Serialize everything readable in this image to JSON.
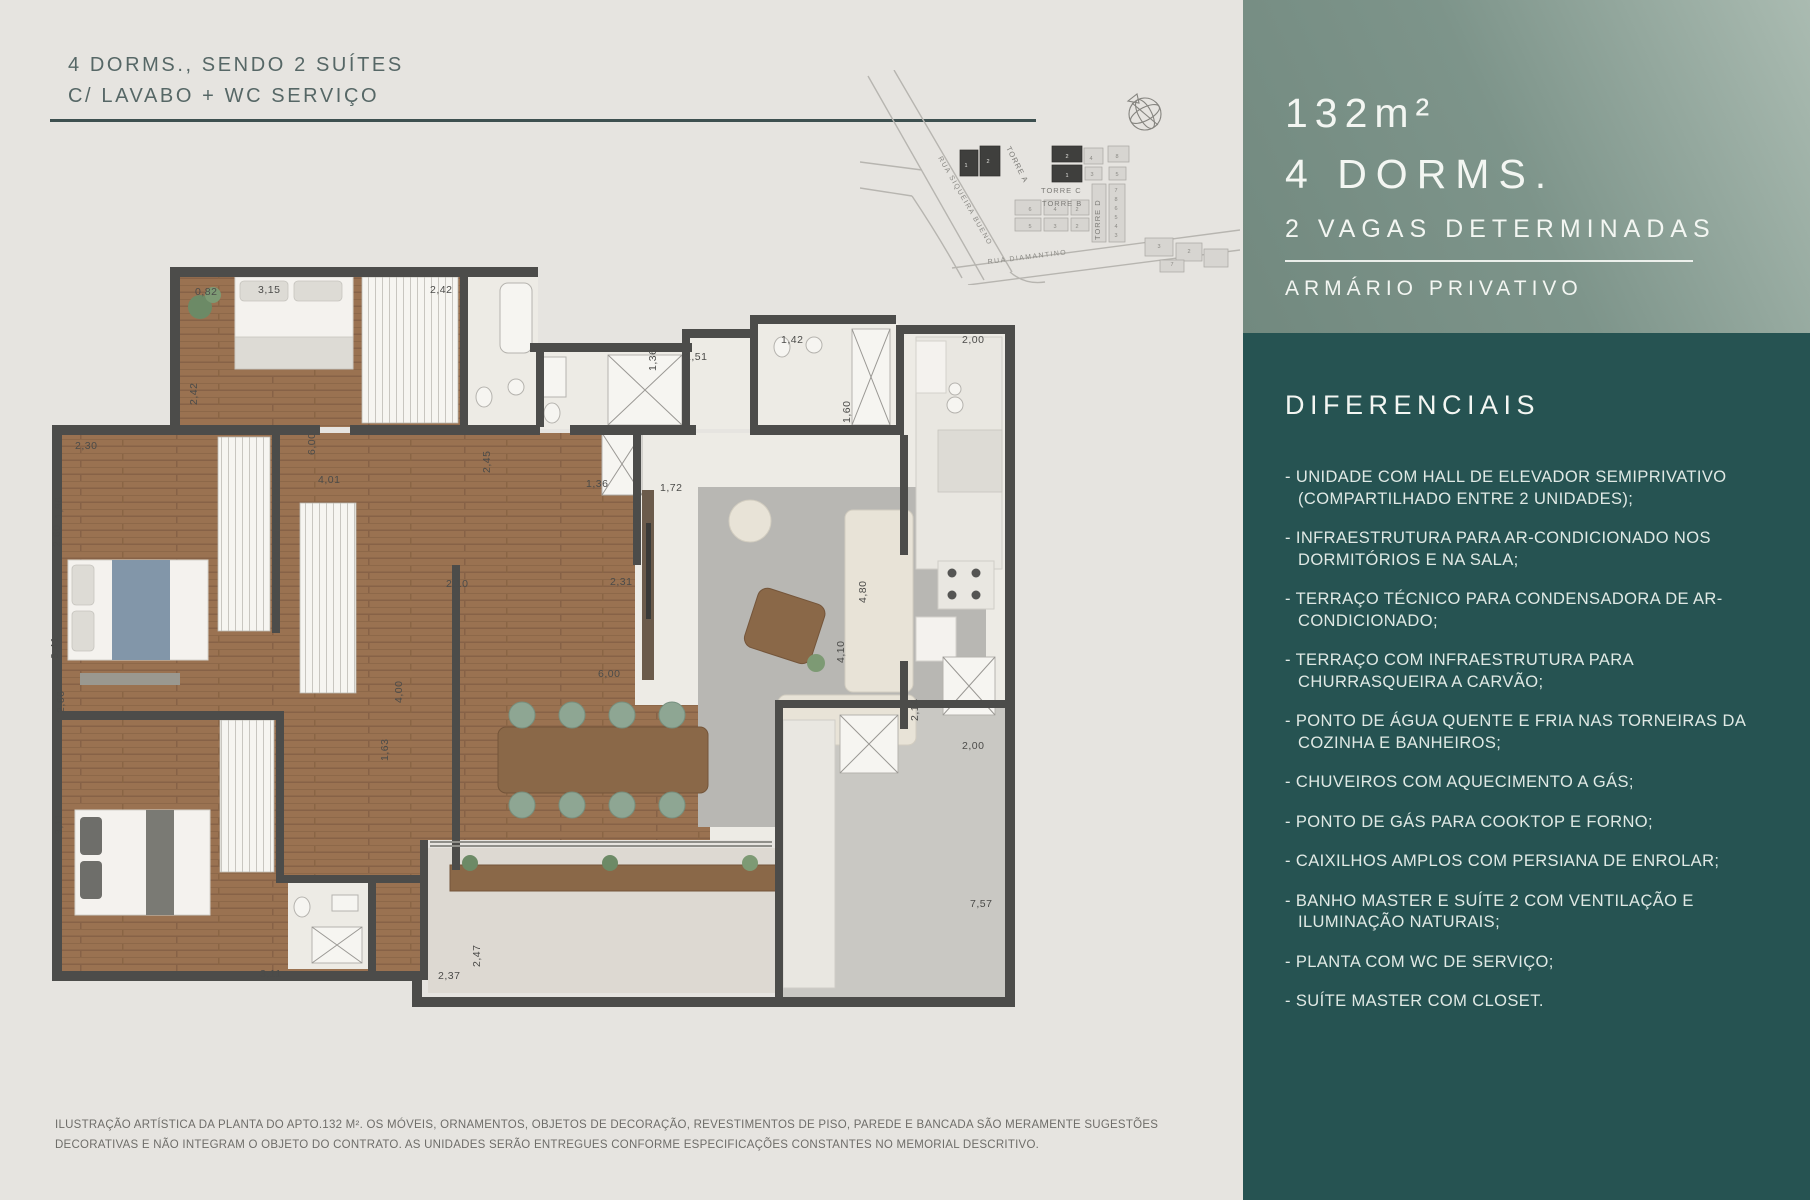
{
  "colors": {
    "page_bg": "#e6e4e0",
    "title_text": "#566766",
    "rule": "#3e5050",
    "panel_top_gradient_start": "#aabbb1",
    "panel_top_gradient_mid": "#7d948a",
    "panel_top_gradient_end": "#72897f",
    "panel_bottom_bg": "#265352",
    "panel_text": "#f3f6f2",
    "list_text": "#e0e9e5",
    "wall": "#4c4c4a",
    "wood_floor": "#9a7251",
    "tile_floor": "#edebe5",
    "rug": "#b8b7b3",
    "chair_green": "#8ea693",
    "disclaimer_text": "#6e6d69"
  },
  "header": {
    "title_line1": "4 DORMS., SENDO 2 SUÍTES",
    "title_line2": "C/ LAVABO + WC SERVIÇO"
  },
  "sitemap": {
    "street_1": "RUA SIQUEIRA BUENO",
    "street_2": "RUA DIAMANTINO",
    "tower_a": "TORRE A",
    "tower_c": "TORRE C",
    "tower_b": "TORRE B",
    "tower_d": "TORRE D",
    "compass_icon": "compass-globe",
    "dark_unit_labels": [
      {
        "x": 106,
        "y": 97,
        "t": "1"
      },
      {
        "x": 128,
        "y": 93,
        "t": "2"
      },
      {
        "x": 207,
        "y": 88,
        "t": "2"
      },
      {
        "x": 207,
        "y": 107,
        "t": "1"
      }
    ],
    "light_unit_labels": [
      {
        "x": 231,
        "y": 90,
        "t": "4"
      },
      {
        "x": 257,
        "y": 88,
        "t": "8"
      },
      {
        "x": 232,
        "y": 106,
        "t": "3"
      },
      {
        "x": 257,
        "y": 106,
        "t": "5"
      },
      {
        "x": 256,
        "y": 122,
        "t": "7"
      },
      {
        "x": 256,
        "y": 131,
        "t": "8"
      },
      {
        "x": 256,
        "y": 140,
        "t": "6"
      },
      {
        "x": 256,
        "y": 149,
        "t": "5"
      },
      {
        "x": 256,
        "y": 158,
        "t": "4"
      },
      {
        "x": 256,
        "y": 167,
        "t": "3"
      },
      {
        "x": 170,
        "y": 141,
        "t": "6"
      },
      {
        "x": 195,
        "y": 141,
        "t": "4"
      },
      {
        "x": 217,
        "y": 141,
        "t": "2"
      },
      {
        "x": 170,
        "y": 158,
        "t": "5"
      },
      {
        "x": 195,
        "y": 158,
        "t": "3"
      },
      {
        "x": 217,
        "y": 158,
        "t": "2"
      },
      {
        "x": 299,
        "y": 178,
        "t": "3"
      },
      {
        "x": 329,
        "y": 183,
        "t": "2"
      },
      {
        "x": 312,
        "y": 196,
        "t": "7"
      }
    ]
  },
  "floorplan": {
    "dimensions": [
      {
        "x": 145,
        "y": 30,
        "t": "0,82"
      },
      {
        "x": 208,
        "y": 28,
        "t": "3,15"
      },
      {
        "x": 380,
        "y": 28,
        "t": "2,42"
      },
      {
        "x": 147,
        "y": 140,
        "r": -90,
        "t": "2,42"
      },
      {
        "x": 440,
        "y": 208,
        "r": -90,
        "t": "2,45"
      },
      {
        "x": 536,
        "y": 222,
        "t": "1,36"
      },
      {
        "x": 610,
        "y": 226,
        "t": "1,72"
      },
      {
        "x": 635,
        "y": 95,
        "t": "1,51"
      },
      {
        "x": 606,
        "y": 106,
        "r": -90,
        "t": "1,36"
      },
      {
        "x": 731,
        "y": 78,
        "t": "1,42"
      },
      {
        "x": 912,
        "y": 78,
        "t": "2,00"
      },
      {
        "x": 800,
        "y": 158,
        "r": -90,
        "t": "1,60"
      },
      {
        "x": 25,
        "y": 184,
        "t": "2,30"
      },
      {
        "x": 268,
        "y": 218,
        "t": "4,01"
      },
      {
        "x": 265,
        "y": 190,
        "r": -90,
        "t": "6,00"
      },
      {
        "x": 12,
        "y": 254,
        "r": -90,
        "t": "1,86"
      },
      {
        "x": 10,
        "y": 282,
        "r": -90,
        "t": "2,60"
      },
      {
        "x": 396,
        "y": 322,
        "t": "2,10"
      },
      {
        "x": 560,
        "y": 320,
        "t": "2,31"
      },
      {
        "x": 8,
        "y": 394,
        "r": -90,
        "t": "3,41"
      },
      {
        "x": 14,
        "y": 448,
        "r": -90,
        "t": "2,66"
      },
      {
        "x": 816,
        "y": 338,
        "r": -90,
        "t": "4,80"
      },
      {
        "x": 794,
        "y": 398,
        "r": -90,
        "t": "4,10"
      },
      {
        "x": 548,
        "y": 412,
        "t": "6,00"
      },
      {
        "x": 868,
        "y": 456,
        "r": -90,
        "t": "2,14"
      },
      {
        "x": 912,
        "y": 484,
        "t": "2,00"
      },
      {
        "x": 338,
        "y": 496,
        "r": -90,
        "t": "1,63"
      },
      {
        "x": 352,
        "y": 438,
        "r": -90,
        "t": "4,00"
      },
      {
        "x": 12,
        "y": 570,
        "r": -90,
        "t": "3,11"
      },
      {
        "x": 210,
        "y": 712,
        "t": "3,11"
      },
      {
        "x": 388,
        "y": 714,
        "t": "2,37"
      },
      {
        "x": 430,
        "y": 702,
        "r": -90,
        "t": "2,47"
      },
      {
        "x": 920,
        "y": 642,
        "t": "7,57"
      }
    ]
  },
  "disclaimer": {
    "line1": "ILUSTRAÇÃO ARTÍSTICA DA PLANTA DO APTO.132 M². OS MÓVEIS, ORNAMENTOS, OBJETOS DE DECORAÇÃO, REVESTIMENTOS DE PISO, PAREDE E BANCADA SÃO MERAMENTE SUGESTÕES",
    "line2": "DECORATIVAS E NÃO INTEGRAM O OBJETO DO CONTRATO. AS UNIDADES SERÃO ENTREGUES CONFORME ESPECIFICAÇÕES CONSTANTES NO MEMORIAL DESCRITIVO."
  },
  "panel": {
    "area": "132m²",
    "dorms": "4 DORMS.",
    "vagas": "2 VAGAS DETERMINADAS",
    "storage": "ARMÁRIO PRIVATIVO",
    "section_title": "DIFERENCIAIS",
    "items": [
      "- UNIDADE COM HALL DE ELEVADOR SEMIPRIVATIVO (COMPARTILHADO ENTRE 2 UNIDADES);",
      "- INFRAESTRUTURA PARA AR-CONDICIONADO NOS DORMITÓRIOS E NA SALA;",
      "- TERRAÇO TÉCNICO PARA CONDENSADORA DE AR-CONDICIONADO;",
      "- TERRAÇO COM INFRAESTRUTURA PARA CHURRASQUEIRA A CARVÃO;",
      "- PONTO DE ÁGUA QUENTE E FRIA NAS TORNEIRAS DA COZINHA E BANHEIROS;",
      "- CHUVEIROS COM AQUECIMENTO A GÁS;",
      "- PONTO DE GÁS PARA COOKTOP E FORNO;",
      "- CAIXILHOS AMPLOS COM PERSIANA DE ENROLAR;",
      "- BANHO MASTER E SUÍTE 2 COM VENTILAÇÃO E ILUMINAÇÃO NATURAIS;",
      "- PLANTA COM WC DE SERVIÇO;",
      "- SUÍTE MASTER COM CLOSET."
    ]
  }
}
